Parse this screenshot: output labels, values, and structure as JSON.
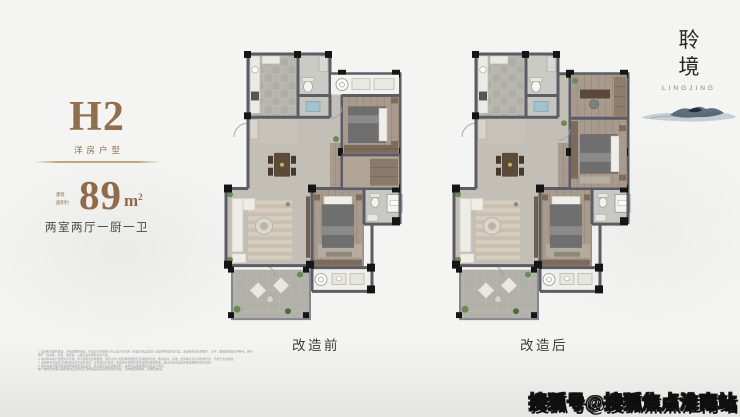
{
  "unit_panel": {
    "code": "H2",
    "type_label": "洋房户型",
    "area_prefix_top": "建筑",
    "area_prefix_bottom": "面积约",
    "area_value": "89",
    "area_unit": "m",
    "area_sup": "2",
    "rooms_label": "两室两厅一厨一卫"
  },
  "plans": {
    "before_caption": "改造前",
    "after_caption": "改造后"
  },
  "brand": {
    "char_top": "聆",
    "char_bottom": "境",
    "latin": "LINGJING"
  },
  "disclaimer": {
    "para1_lines": [
      "1. 本资料为要约邀请，不构成要约承诺，买卖双方的权利义务以双方签订的《商品房买卖合同》及其附件等协议为准。本资料所涉及的图片、文字、数据等内容仅供参考，相关细节（含道路、景观、配套等）以政府最终审批文件为准。",
      "2. 本资料中的户型图为示意图，所示面积为建筑面积，实际交付以政府审批图纸及实测面积为准；图中家具、家电、装饰等仅为空间利用示意，不属于交付标准。",
      "3. 本资料中对改造空间的展示仅为设计建议，不构成交付承诺；改造需符合相关法律法规及规划要求，由业主自行实施并承担相应风险与责任。",
      "4. 相关内容可能因规划调整等原因发生变化，敬请留意最新发布资料，本资料最终解释权归出卖人所有。"
    ],
    "para2": "本广告所示内容以政府批文及双方签订的商品房买卖合同约定为准，不构成逐项承诺，请悉知体谅。"
  },
  "watermark": "搜狐号@搜狐焦点淮南站",
  "colors": {
    "accent_brown": "#8f6b4b",
    "wall": "#5c5c66",
    "text_dark": "#3c3c3c"
  }
}
